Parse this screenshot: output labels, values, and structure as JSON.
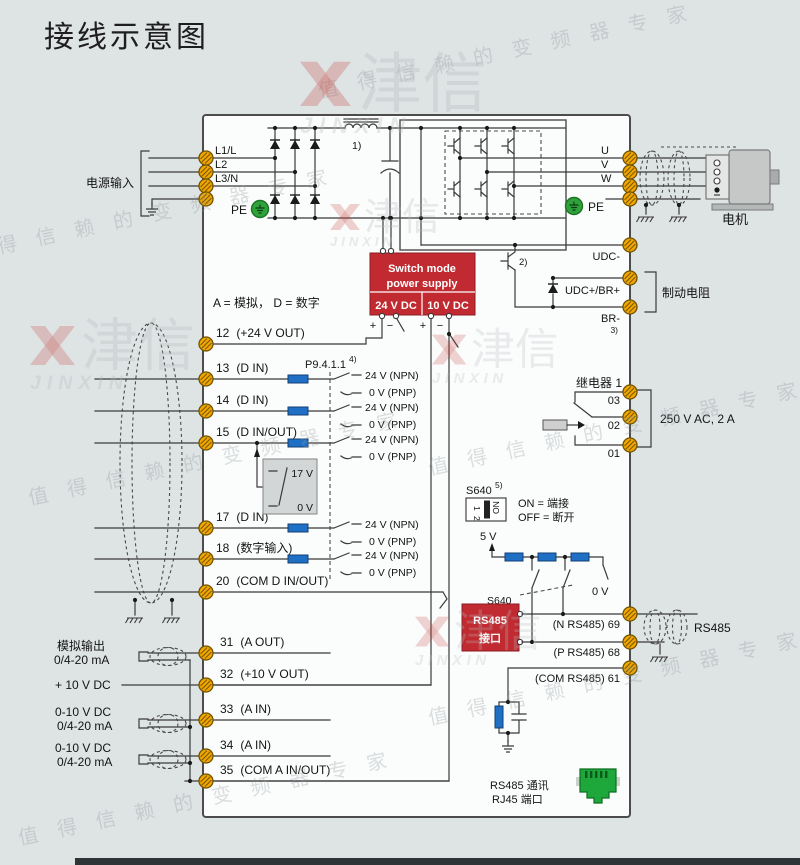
{
  "title": "接线示意图",
  "watermark": {
    "slogan_spaced": "值 得 信 赖 的 变 频 器 专 家",
    "brand_cn": "津信",
    "brand_en": "JINXIN"
  },
  "legend": "A = 模拟， D = 数字",
  "power_input": {
    "label": "电源输入",
    "l1": "L1/L",
    "l2": "L2",
    "l3": "L3/N",
    "pe": "PE"
  },
  "notes": {
    "n1": "1)",
    "n2": "2)",
    "n3": "3)",
    "n4": "4)",
    "n5": "5)"
  },
  "psu": {
    "line1": "Switch mode",
    "line2": "power supply",
    "v24": "24 V DC",
    "v10": "10 V DC",
    "plus": "+",
    "minus": "−"
  },
  "dc": {
    "udc_minus": "UDC-",
    "udc_plus": "UDC+/BR+",
    "br": "BR-",
    "brake_resistor": "制动电阻"
  },
  "motor": {
    "u": "U",
    "v": "V",
    "w": "W",
    "pe": "PE",
    "label": "电机"
  },
  "din": {
    "p_ref": "P9.4.1.1",
    "threshold_high": "17 V",
    "threshold_low": "0 V",
    "rows": [
      {
        "num": "12",
        "name": "(+24 V OUT)"
      },
      {
        "num": "13",
        "name": "(D IN)",
        "npn": "24 V (NPN)",
        "pnp": "0 V (PNP)"
      },
      {
        "num": "14",
        "name": "(D IN)",
        "npn": "24 V (NPN)",
        "pnp": "0 V (PNP)"
      },
      {
        "num": "15",
        "name": "(D IN/OUT)",
        "npn": "24 V (NPN)",
        "pnp": "0 V (PNP)"
      },
      {
        "num": "17",
        "name": "(D IN)",
        "npn": "24 V (NPN)",
        "pnp": "0 V (PNP)"
      },
      {
        "num": "18",
        "name": "(数字输入)",
        "npn": "24 V (NPN)",
        "pnp": "0 V (PNP)"
      },
      {
        "num": "20",
        "name": "(COM D IN/OUT)"
      }
    ]
  },
  "relay": {
    "title": "继电器 1",
    "t03": "03",
    "t02": "02",
    "t01": "01",
    "rating": "250 V AC, 2 A"
  },
  "s640": {
    "label": "S640",
    "dip_1": "1",
    "dip_2": "2",
    "dip_on": "ON",
    "on_rule": "ON = 端接",
    "off_rule": "OFF = 断开",
    "v5": "5 V",
    "v0": "0 V",
    "switch_ref": "S640"
  },
  "rs485": {
    "box_line1": "RS485",
    "box_line2": "接口",
    "n": "(N RS485) 69",
    "p": "(P RS485) 68",
    "com": "(COM RS485) 61",
    "cable": "RS485",
    "comm_line1": "RS485 通讯",
    "comm_line2": "RJ45 端口"
  },
  "analog": {
    "out_label": "模拟输出",
    "out_range": "0/4-20 mA",
    "v10": "+ 10 V DC",
    "in1_type": "0-10 V DC",
    "in1_range": "0/4-20 mA",
    "in2_type": "0-10 V DC",
    "in2_range": "0/4-20 mA",
    "rows": [
      {
        "num": "31",
        "name": "(A OUT)"
      },
      {
        "num": "32",
        "name": "(+10 V OUT)"
      },
      {
        "num": "33",
        "name": "(A IN)"
      },
      {
        "num": "34",
        "name": "(A IN)"
      },
      {
        "num": "35",
        "name": "(COM A IN/OUT)"
      }
    ]
  },
  "colors": {
    "red": "#c02a30",
    "terminal_orange": "#f3a600",
    "pe_green": "#2fa23c",
    "resistor_blue": "#1f6fc5",
    "bg": "#dee3e4",
    "line": "#3a3a3a"
  }
}
